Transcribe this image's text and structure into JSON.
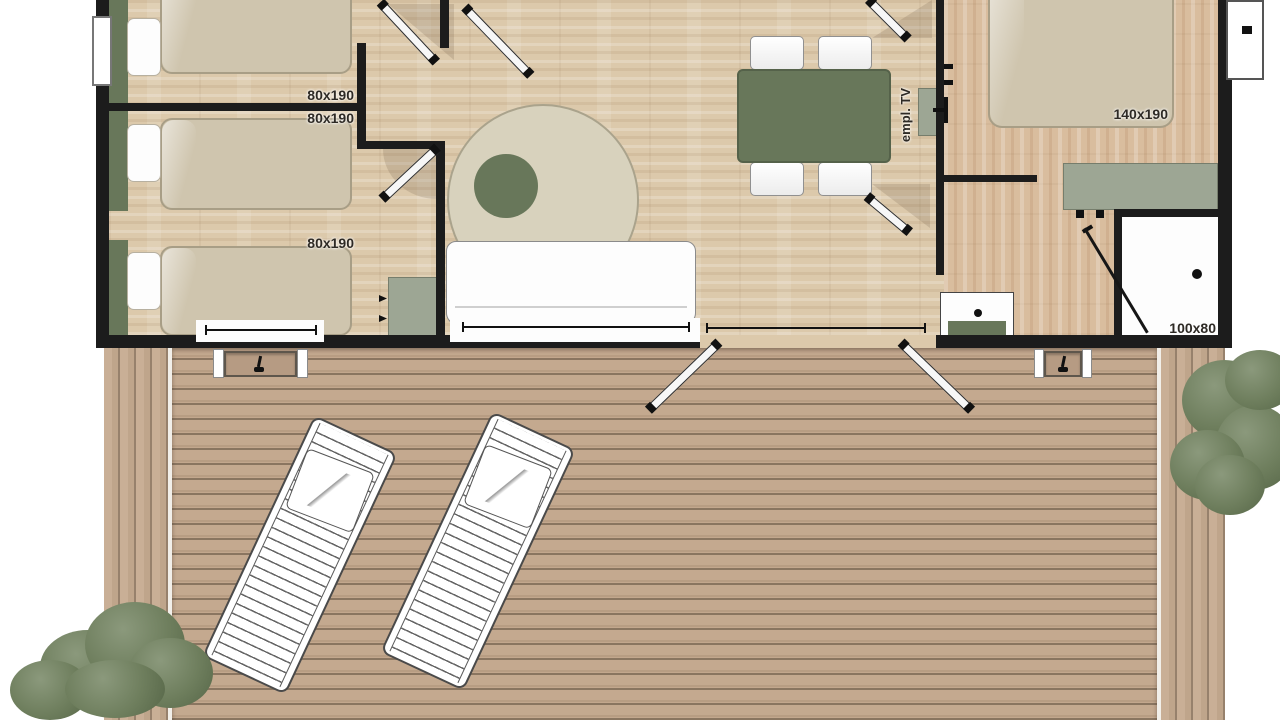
{
  "plan_labels": {
    "bed1": "80x190",
    "bed2": "80x190",
    "bed3": "80x190",
    "double_bed": "140x190",
    "shower": "100x80",
    "tv": "empl. TV"
  },
  "colors": {
    "wall": "#1c1c1c",
    "floor": "#dcc9ab",
    "floor-right": "#d9bd9e",
    "bed": "#cfc5ae",
    "bed-border": "#a89e86",
    "green": "#68775a",
    "cabinet": "#9da694",
    "cabinet-border": "#767d6c",
    "rug": "#d8d2bd",
    "rug-border": "#aaa38c",
    "deck": "#c4a98f",
    "deck-dark": "#8a7560",
    "deck-side": "#c9af96",
    "tree-light": "#8b997c",
    "tree-mid": "#6e7e5d",
    "tree-dark": "#5c6c4d",
    "label": "#2e2a25"
  }
}
